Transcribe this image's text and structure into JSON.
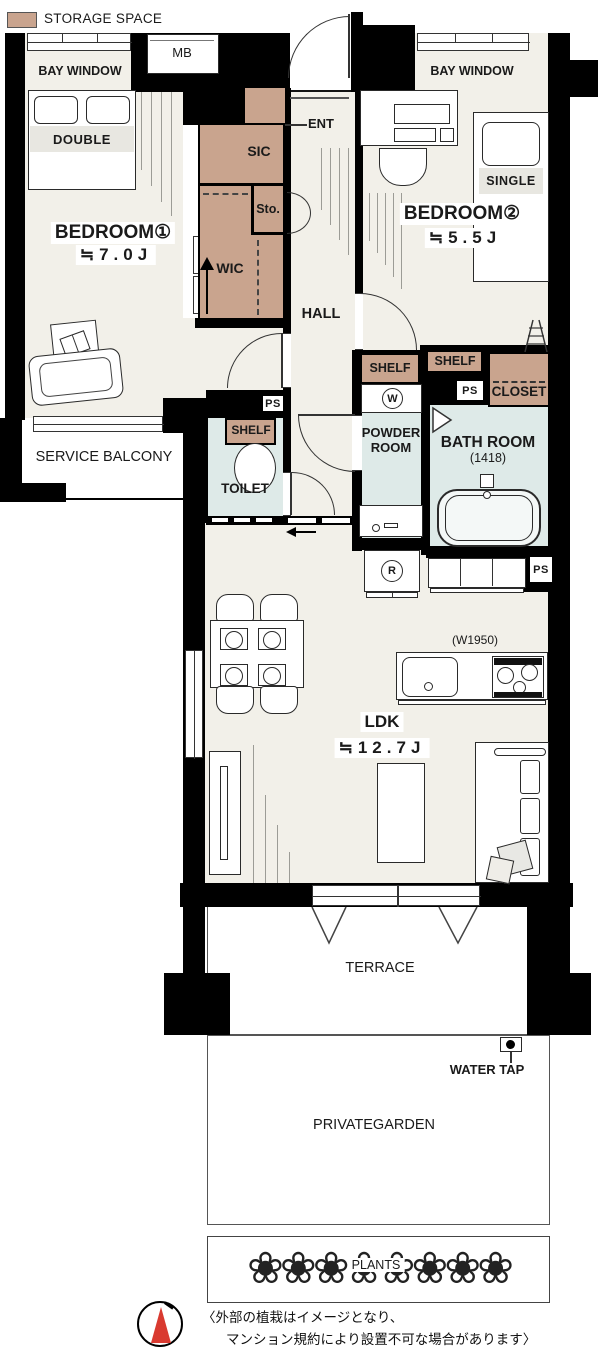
{
  "legend": {
    "storage_space": "STORAGE SPACE"
  },
  "colors": {
    "storage_tan": "#C9A48E",
    "floor_cream": "#F2F0E9",
    "wet_blue": "#DEEAE8",
    "wall_black": "#000000",
    "band_gray": "#E8E7E1",
    "compass_red": "#D93A30",
    "line_gray": "#9C9C96"
  },
  "rooms": {
    "bedroom1": {
      "name": "BEDROOM①",
      "area": "≒7.0J"
    },
    "bedroom2": {
      "name": "BEDROOM②",
      "area": "≒5.5J"
    },
    "ldk": {
      "name": "LDK",
      "area": "≒12.7J"
    },
    "hall": {
      "name": "HALL"
    },
    "ent": {
      "name": "ENT"
    },
    "toilet": {
      "name": "TOILET"
    },
    "powder_room": {
      "name_line1": "POWDER",
      "name_line2": "ROOM"
    },
    "bath_room": {
      "name": "BATH ROOM",
      "size": "(1418)"
    },
    "service_balcony": {
      "name": "SERVICE BALCONY"
    },
    "terrace": {
      "name": "TERRACE"
    },
    "private_garden": {
      "name": "PRIVATEGARDEN"
    },
    "plants": {
      "name": "PLANTS"
    }
  },
  "storage": {
    "mb": "MB",
    "sic": "SIC",
    "sto": "Sto.",
    "wic": "WIC",
    "closet": "CLOSET",
    "shelf": "SHELF"
  },
  "fixtures": {
    "bay_window": "BAY WINDOW",
    "double_bed": "DOUBLE",
    "single_bed": "SINGLE",
    "washer": "W",
    "fridge": "R",
    "ps": "PS",
    "kitchen_width": "(W1950)",
    "water_tap": "WATER TAP",
    "flower_row": "❀❀❀❀❀❀❀❀"
  },
  "note": {
    "line1": "〈外部の植栽はイメージとなり、",
    "line2": "マンション規約により設置不可な場合があります〉"
  }
}
